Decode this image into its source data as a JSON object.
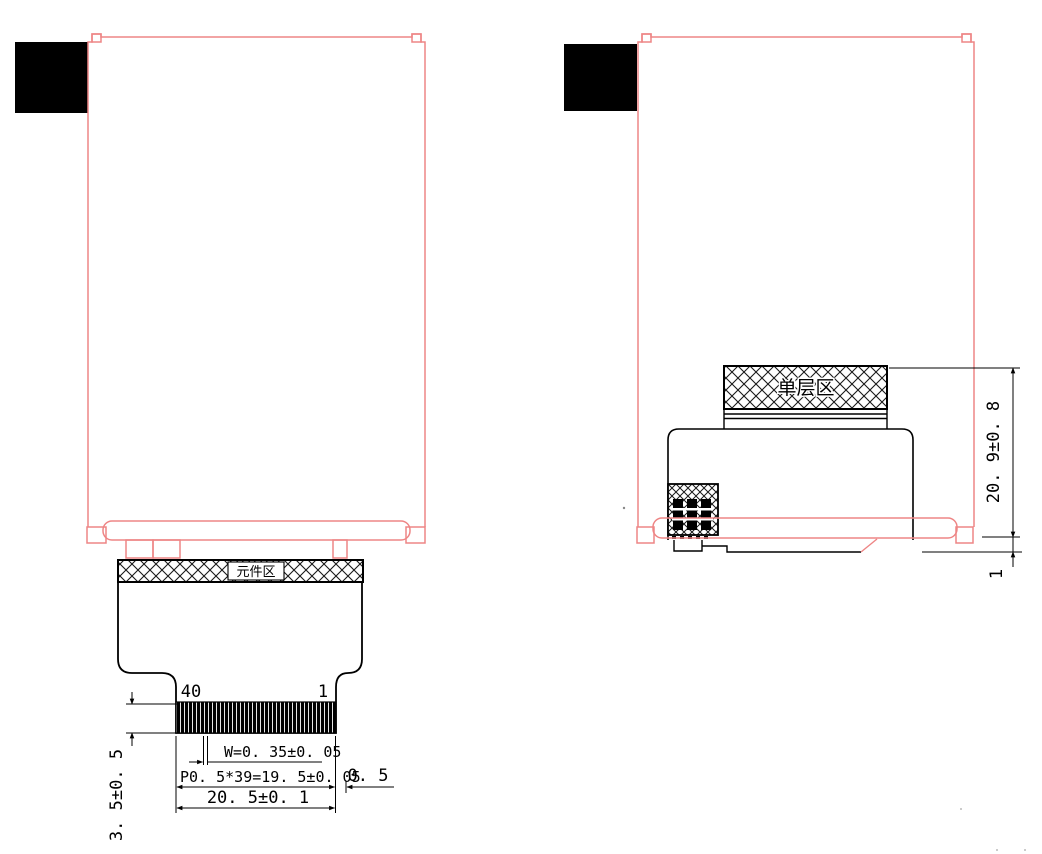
{
  "drawing": {
    "front_view": {
      "component_area_label": "元件区",
      "pin_last_label": "40",
      "pin_first_label": "1",
      "dims": {
        "pin_width": "W=0. 35±0. 05",
        "pitch_span": "P0. 5*39=19. 5±0. 05",
        "edge_margin": "0. 5",
        "total_width": "20. 5±0. 1",
        "tail_height": "3. 5±0. 5"
      }
    },
    "side_view": {
      "single_layer_label": "单层区",
      "dims": {
        "total_height": "20. 9±0. 8",
        "fold_offset": "1"
      }
    },
    "colors": {
      "outline_pink": "#EE8585",
      "line_black": "#000000"
    }
  }
}
